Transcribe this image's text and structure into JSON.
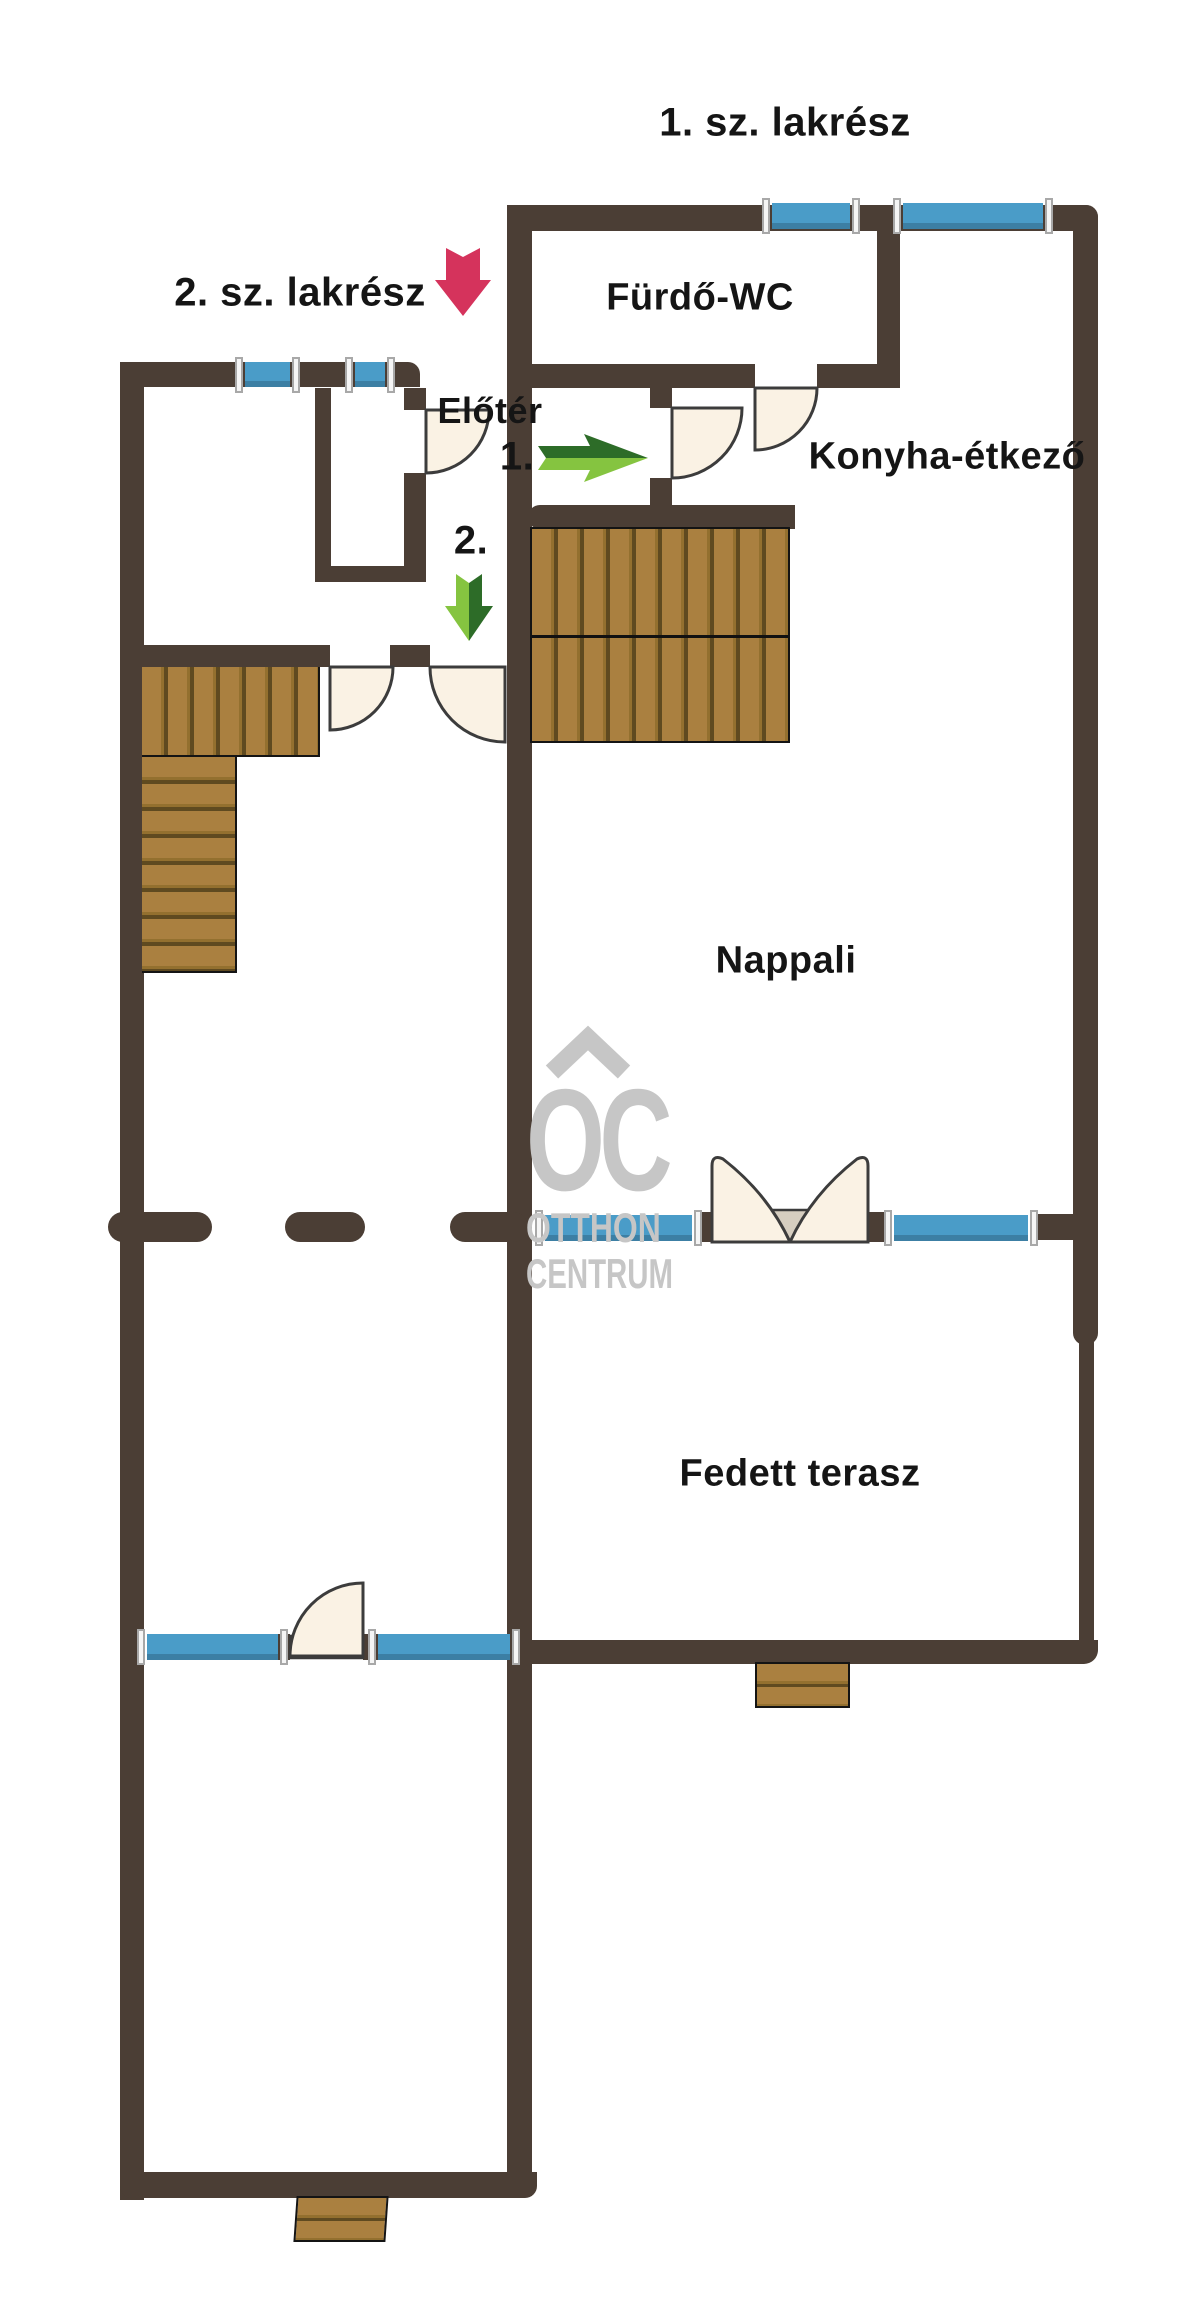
{
  "sections": {
    "unit1": "1. sz. lakrész",
    "unit2": "2. sz. lakrész"
  },
  "rooms": {
    "bathroom": "Fürdő-WC",
    "hall": "Előtér",
    "kitchen": "Konyha-étkező",
    "living": "Nappali",
    "terrace": "Fedett terasz"
  },
  "markers": {
    "entrance1": "1.",
    "entrance2": "2."
  },
  "watermark": {
    "line1": "OC",
    "line2": "OTTHON",
    "line3": "CENTRUM"
  },
  "icons": {
    "pink_arrow": "down-arrow-to-unit2",
    "green_arrow_right": "entrance-1-direction",
    "green_arrow_down": "entrance-2-direction"
  },
  "palette": {
    "wall": "#4b3e35",
    "window_blue": "#4a9cc8",
    "window_frame": "#f5f5f5",
    "wood": "#aa8040",
    "wood_mid": "#93702f",
    "wood_gap": "#5f4a20",
    "door_fill": "#faf2e4",
    "door_stroke": "#3c3c3c",
    "threshold": "#d6cec0",
    "arrow_pink": "#d5335c",
    "arrow_green_dark": "#2d6c28",
    "arrow_green_light": "#85c440",
    "watermark_gray": "#c6c6c6",
    "label_text": "#151515"
  }
}
